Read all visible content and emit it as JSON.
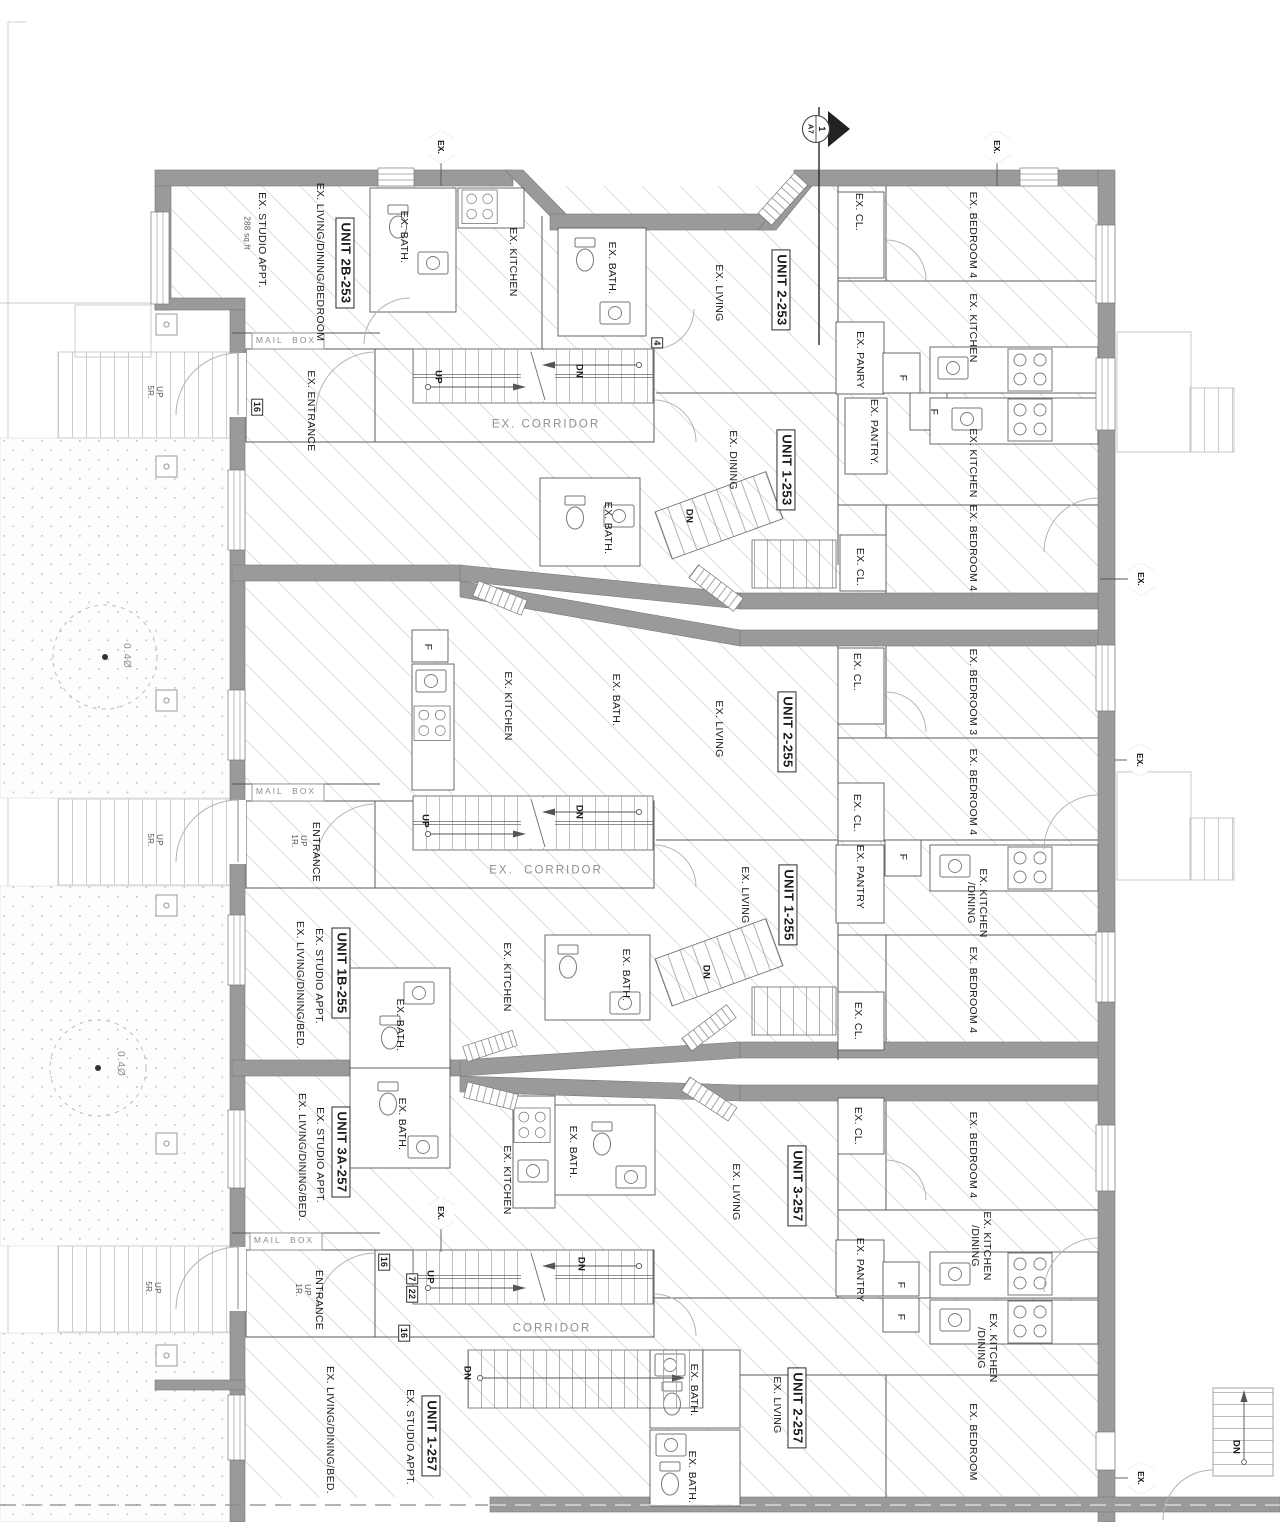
{
  "page": {
    "width": 1280,
    "height": 1522,
    "background": "#ffffff"
  },
  "colors": {
    "wall": "#9a9a9a",
    "wall_stroke": "#787878",
    "partition": "#5a5a5a",
    "hatch": "#dedede",
    "dots": "#c4c4c4",
    "light_outline": "#c8c8c8",
    "text": "#1b1b1b",
    "muted_text": "#8e8e8e"
  },
  "section_marker": {
    "number": "1",
    "sheet": "A7"
  },
  "hexagons": [
    {
      "name": "ex-marker-top-left",
      "text": "EX.",
      "x": 441,
      "y": 147
    },
    {
      "name": "ex-marker-top-right",
      "text": "EX.",
      "x": 997,
      "y": 147
    },
    {
      "name": "ex-marker-right-1",
      "text": "EX.",
      "x": 1141,
      "y": 579
    },
    {
      "name": "ex-marker-right-2",
      "text": "EX.",
      "x": 1140,
      "y": 760
    },
    {
      "name": "ex-marker-mid-bottom",
      "text": "EX.",
      "x": 441,
      "y": 1213
    },
    {
      "name": "ex-marker-bottom-right",
      "text": "EX.",
      "x": 1141,
      "y": 1478
    }
  ],
  "labels": [
    {
      "name": "area-note-unit2b253",
      "text": "288 sq.ft",
      "x": 247,
      "y": 233,
      "rot": 90,
      "style": "small"
    },
    {
      "name": "room-studio-appt-253",
      "text": "EX. STUDIO APPT.",
      "x": 262,
      "y": 240,
      "rot": 90,
      "style": "room"
    },
    {
      "name": "room-living-dining-bedroom-253",
      "text": "EX. LIVING/DINING/BEDROOM",
      "x": 320,
      "y": 262,
      "rot": 90,
      "style": "room"
    },
    {
      "name": "unit-2b-253",
      "text": "UNIT 2B-253",
      "x": 345,
      "y": 263,
      "rot": 90,
      "style": "unit"
    },
    {
      "name": "room-bath-2b253",
      "text": "EX. BATH.",
      "x": 404,
      "y": 237,
      "rot": 90,
      "style": "room"
    },
    {
      "name": "room-kitchen-2b253",
      "text": "EX. KITCHEN",
      "x": 513,
      "y": 262,
      "rot": 90,
      "style": "room"
    },
    {
      "name": "room-bath-2-253",
      "text": "EX. BATH.",
      "x": 612,
      "y": 268,
      "rot": 90,
      "style": "room"
    },
    {
      "name": "room-living-2-253",
      "text": "EX. LIVING",
      "x": 719,
      "y": 293,
      "rot": 90,
      "style": "room"
    },
    {
      "name": "unit-2-253",
      "text": "UNIT 2-253",
      "x": 781,
      "y": 290,
      "rot": 90,
      "style": "unit"
    },
    {
      "name": "room-closet-2-253",
      "text": "EX. CL.",
      "x": 859,
      "y": 212,
      "rot": 90,
      "style": "room"
    },
    {
      "name": "room-bedroom4-2-253",
      "text": "EX. BEDROOM 4",
      "x": 973,
      "y": 235,
      "rot": 90,
      "style": "room"
    },
    {
      "name": "room-pantry-2-253",
      "text": "EX. PANRY",
      "x": 860,
      "y": 360,
      "rot": 90,
      "style": "room"
    },
    {
      "name": "fridge-2-253",
      "text": "F",
      "x": 903,
      "y": 378,
      "rot": 90,
      "style": "room"
    },
    {
      "name": "room-kitchen-2-253",
      "text": "EX. KITCHEN",
      "x": 973,
      "y": 328,
      "rot": 90,
      "style": "room"
    },
    {
      "name": "mailbox-253",
      "text": "MAIL  BOX",
      "x": 286,
      "y": 341,
      "rot": 0,
      "style": "mail"
    },
    {
      "name": "room-entrance-253",
      "text": "EX. ENTRANCE",
      "x": 311,
      "y": 411,
      "rot": 90,
      "style": "room"
    },
    {
      "name": "tag-16-253",
      "text": "16",
      "x": 257,
      "y": 407,
      "rot": 90,
      "style": "tag"
    },
    {
      "name": "stair-up-253",
      "text": "UP",
      "x": 437,
      "y": 377,
      "rot": 90,
      "style": "updn"
    },
    {
      "name": "stair-dn-253",
      "text": "DN",
      "x": 578,
      "y": 371,
      "rot": 90,
      "style": "updn"
    },
    {
      "name": "corridor-253",
      "text": "EX. CORRIDOR",
      "x": 546,
      "y": 425,
      "rot": 0,
      "style": "corr"
    },
    {
      "name": "tag-4-253",
      "text": "4",
      "x": 657,
      "y": 343,
      "rot": 90,
      "style": "tag"
    },
    {
      "name": "room-pantry-1-253",
      "text": "EX. PANTRY.",
      "x": 874,
      "y": 432,
      "rot": 90,
      "style": "room"
    },
    {
      "name": "fridge-1-253",
      "text": "F",
      "x": 934,
      "y": 412,
      "rot": 90,
      "style": "room"
    },
    {
      "name": "room-kitchen-1-253",
      "text": "EX. KITCHEN",
      "x": 973,
      "y": 463,
      "rot": 90,
      "style": "room"
    },
    {
      "name": "room-dining-1-253",
      "text": "EX. DINING",
      "x": 733,
      "y": 460,
      "rot": 90,
      "style": "room"
    },
    {
      "name": "unit-1-253",
      "text": "UNIT 1-253",
      "x": 786,
      "y": 470,
      "rot": 90,
      "style": "unit"
    },
    {
      "name": "room-bath-1-253",
      "text": "EX. BATH.",
      "x": 608,
      "y": 528,
      "rot": 90,
      "style": "room"
    },
    {
      "name": "stair-dn-1-253",
      "text": "DN",
      "x": 688,
      "y": 516,
      "rot": 90,
      "style": "updn"
    },
    {
      "name": "room-closet-1-253",
      "text": "EX. CL.",
      "x": 860,
      "y": 567,
      "rot": 90,
      "style": "room"
    },
    {
      "name": "room-bedroom4-1-253",
      "text": "EX. BEDROOM 4",
      "x": 973,
      "y": 548,
      "rot": 90,
      "style": "room"
    },
    {
      "name": "fridge-2-255",
      "text": "F",
      "x": 428,
      "y": 647,
      "rot": 90,
      "style": "room"
    },
    {
      "name": "room-kitchen-2-255",
      "text": "EX. KITCHEN",
      "x": 508,
      "y": 706,
      "rot": 90,
      "style": "room"
    },
    {
      "name": "room-bath-2-255",
      "text": "EX. BATH.",
      "x": 616,
      "y": 700,
      "rot": 90,
      "style": "room"
    },
    {
      "name": "room-living-2-255",
      "text": "EX. LIVING",
      "x": 719,
      "y": 729,
      "rot": 90,
      "style": "room"
    },
    {
      "name": "unit-2-255",
      "text": "UNIT 2-255",
      "x": 787,
      "y": 732,
      "rot": 90,
      "style": "unit"
    },
    {
      "name": "room-closet-a-2-255",
      "text": "EX. CL.",
      "x": 857,
      "y": 672,
      "rot": 90,
      "style": "room"
    },
    {
      "name": "room-bedroom3-2-255",
      "text": "EX. BEDROOM 3",
      "x": 973,
      "y": 692,
      "rot": 90,
      "style": "room"
    },
    {
      "name": "room-closet-b-2-255",
      "text": "EX. CL.",
      "x": 857,
      "y": 813,
      "rot": 90,
      "style": "room"
    },
    {
      "name": "room-bedroom4-2-255",
      "text": "EX. BEDROOM 4",
      "x": 973,
      "y": 792,
      "rot": 90,
      "style": "room"
    },
    {
      "name": "mailbox-255",
      "text": "MAIL  BOX",
      "x": 286,
      "y": 792,
      "rot": 0,
      "style": "mail"
    },
    {
      "name": "room-entrance-255",
      "text": "ENTRANCE",
      "x": 316,
      "y": 852,
      "rot": 90,
      "style": "room"
    },
    {
      "name": "note-up-1r-255",
      "text": "UP\n1R.",
      "x": 299,
      "y": 841,
      "rot": 90,
      "style": "small"
    },
    {
      "name": "stair-up-255",
      "text": "UP",
      "x": 424,
      "y": 821,
      "rot": 90,
      "style": "updn"
    },
    {
      "name": "stair-dn-255",
      "text": "DN",
      "x": 578,
      "y": 812,
      "rot": 90,
      "style": "updn"
    },
    {
      "name": "corridor-255",
      "text": "EX.  CORRIDOR",
      "x": 546,
      "y": 871,
      "rot": 0,
      "style": "corr"
    },
    {
      "name": "room-pantry-1-255",
      "text": "EX. PANTRY",
      "x": 860,
      "y": 877,
      "rot": 90,
      "style": "room"
    },
    {
      "name": "fridge-1-255",
      "text": "F",
      "x": 903,
      "y": 857,
      "rot": 90,
      "style": "room"
    },
    {
      "name": "room-kitchen-dining-1-255",
      "text": "EX. KITCHEN\n/DINING",
      "x": 977,
      "y": 903,
      "rot": 90,
      "style": "room2"
    },
    {
      "name": "room-living-1-255",
      "text": "EX. LIVING",
      "x": 745,
      "y": 895,
      "rot": 90,
      "style": "room"
    },
    {
      "name": "unit-1-255",
      "text": "UNIT 1-255",
      "x": 788,
      "y": 905,
      "rot": 90,
      "style": "unit"
    },
    {
      "name": "room-bedroom4-1-255",
      "text": "EX. BEDROOM 4",
      "x": 973,
      "y": 990,
      "rot": 90,
      "style": "room"
    },
    {
      "name": "room-closet-1-255",
      "text": "EX. CL.",
      "x": 858,
      "y": 1021,
      "rot": 90,
      "style": "room"
    },
    {
      "name": "stair-dn-1-255",
      "text": "DN",
      "x": 705,
      "y": 972,
      "rot": 90,
      "style": "updn"
    },
    {
      "name": "unit-1b-255",
      "text": "UNIT 1B-255",
      "x": 341,
      "y": 973,
      "rot": 90,
      "style": "unit"
    },
    {
      "name": "room-studio-appt-1b255",
      "text": "EX. STUDIO APPT.",
      "x": 319,
      "y": 976,
      "rot": 90,
      "style": "room"
    },
    {
      "name": "room-living-dining-bed-1b255",
      "text": "EX. LIVING/DINING/BED.",
      "x": 300,
      "y": 985,
      "rot": 90,
      "style": "room"
    },
    {
      "name": "room-bath-a-1b255",
      "text": "EX. BATH.",
      "x": 400,
      "y": 1025,
      "rot": 90,
      "style": "room"
    },
    {
      "name": "room-bath-b-1b255",
      "text": "EX. BATH.",
      "x": 626,
      "y": 975,
      "rot": 90,
      "style": "room"
    },
    {
      "name": "room-kitchen-1b255",
      "text": "EX. KITCHEN",
      "x": 507,
      "y": 977,
      "rot": 90,
      "style": "room"
    },
    {
      "name": "room-bath-a-3a257",
      "text": "EX. BATH.",
      "x": 402,
      "y": 1124,
      "rot": 90,
      "style": "room"
    },
    {
      "name": "room-bath-b-3a257",
      "text": "EX. BATH.",
      "x": 573,
      "y": 1152,
      "rot": 90,
      "style": "room"
    },
    {
      "name": "room-kitchen-3a257",
      "text": "EX. KITCHEN",
      "x": 507,
      "y": 1180,
      "rot": 90,
      "style": "room"
    },
    {
      "name": "unit-3a-257",
      "text": "UNIT 3A-257",
      "x": 341,
      "y": 1152,
      "rot": 90,
      "style": "unit"
    },
    {
      "name": "room-studio-appt-3a257",
      "text": "EX. STUDIO APPT.",
      "x": 320,
      "y": 1155,
      "rot": 90,
      "style": "room"
    },
    {
      "name": "room-living-dining-bed-3a257",
      "text": "EX. LIVING/DINING/BED.",
      "x": 302,
      "y": 1157,
      "rot": 90,
      "style": "room"
    },
    {
      "name": "room-closet-3-257",
      "text": "EX. CL.",
      "x": 858,
      "y": 1126,
      "rot": 90,
      "style": "room"
    },
    {
      "name": "room-bedroom4-3-257",
      "text": "EX. BEDROOM 4",
      "x": 973,
      "y": 1155,
      "rot": 90,
      "style": "room"
    },
    {
      "name": "unit-3-257",
      "text": "UNIT 3-257",
      "x": 797,
      "y": 1186,
      "rot": 90,
      "style": "unit"
    },
    {
      "name": "room-living-3-257",
      "text": "EX. LIVING",
      "x": 736,
      "y": 1192,
      "rot": 90,
      "style": "room"
    },
    {
      "name": "room-kitchen-dining-3-257",
      "text": "EX. KITCHEN\n/DINING",
      "x": 981,
      "y": 1246,
      "rot": 90,
      "style": "room2"
    },
    {
      "name": "room-pantry-3-257",
      "text": "EX. PANTRY",
      "x": 860,
      "y": 1270,
      "rot": 90,
      "style": "room"
    },
    {
      "name": "fridge-3-257",
      "text": "F",
      "x": 901,
      "y": 1285,
      "rot": 90,
      "style": "room"
    },
    {
      "name": "fridge-2-257",
      "text": "F",
      "x": 901,
      "y": 1317,
      "rot": 90,
      "style": "room"
    },
    {
      "name": "room-kitchen-dining-2-257",
      "text": "EX. KITCHEN\n/DINING",
      "x": 987,
      "y": 1348,
      "rot": 90,
      "style": "room2"
    },
    {
      "name": "mailbox-257",
      "text": "MAIL  BOX",
      "x": 284,
      "y": 1241,
      "rot": 0,
      "style": "mail"
    },
    {
      "name": "room-entrance-257",
      "text": "ENTRANCE",
      "x": 319,
      "y": 1300,
      "rot": 90,
      "style": "room"
    },
    {
      "name": "note-up-1r-257",
      "text": "UP\n1R.",
      "x": 303,
      "y": 1290,
      "rot": 90,
      "style": "small"
    },
    {
      "name": "tag-16-257-a",
      "text": "16",
      "x": 384,
      "y": 1262,
      "rot": 90,
      "style": "tag"
    },
    {
      "name": "tag-7-257",
      "text": "7",
      "x": 412,
      "y": 1279,
      "rot": 90,
      "style": "tag"
    },
    {
      "name": "tag-22-257",
      "text": "22",
      "x": 412,
      "y": 1294,
      "rot": 90,
      "style": "tag"
    },
    {
      "name": "stair-up-257",
      "text": "UP",
      "x": 429,
      "y": 1277,
      "rot": 90,
      "style": "updn"
    },
    {
      "name": "stair-dn-257",
      "text": "DN",
      "x": 580,
      "y": 1264,
      "rot": 90,
      "style": "updn"
    },
    {
      "name": "tag-16-257-b",
      "text": "16",
      "x": 404,
      "y": 1333,
      "rot": 90,
      "style": "tag"
    },
    {
      "name": "corridor-257",
      "text": "CORRIDOR",
      "x": 552,
      "y": 1329,
      "rot": 0,
      "style": "corr"
    },
    {
      "name": "stair-dn-lower-257",
      "text": "DN",
      "x": 466,
      "y": 1373,
      "rot": 90,
      "style": "updn"
    },
    {
      "name": "unit-1-257",
      "text": "UNIT 1-257",
      "x": 431,
      "y": 1436,
      "rot": 90,
      "style": "unit"
    },
    {
      "name": "room-studio-appt-1-257",
      "text": "EX. STUDIO APPT.",
      "x": 410,
      "y": 1437,
      "rot": 90,
      "style": "room"
    },
    {
      "name": "room-living-dining-bed-1-257",
      "text": "EX. LIVING/DINING/BED.",
      "x": 330,
      "y": 1430,
      "rot": 90,
      "style": "room"
    },
    {
      "name": "unit-2-257",
      "text": "UNIT 2-257",
      "x": 797,
      "y": 1408,
      "rot": 90,
      "style": "unit"
    },
    {
      "name": "room-living-2-257",
      "text": "EX. LIVING",
      "x": 777,
      "y": 1405,
      "rot": 90,
      "style": "room"
    },
    {
      "name": "room-bedroom-2-257",
      "text": "EX. BEDROOM",
      "x": 973,
      "y": 1442,
      "rot": 90,
      "style": "room"
    },
    {
      "name": "room-bath-a-2-257",
      "text": "EX. BATH.",
      "x": 694,
      "y": 1390,
      "rot": 90,
      "style": "room"
    },
    {
      "name": "room-bath-b-2-257",
      "text": "EX. BATH.",
      "x": 692,
      "y": 1477,
      "rot": 90,
      "style": "room"
    },
    {
      "name": "stair-dn-ext",
      "text": "DN",
      "x": 1235,
      "y": 1447,
      "rot": 90,
      "style": "updn"
    },
    {
      "name": "note-up-5r-1",
      "text": "UP\n5R.",
      "x": 155,
      "y": 392,
      "rot": 90,
      "style": "small"
    },
    {
      "name": "note-up-5r-2",
      "text": "UP\n5R.",
      "x": 155,
      "y": 840,
      "rot": 90,
      "style": "small"
    },
    {
      "name": "note-up-5r-3",
      "text": "UP\n5R.",
      "x": 153,
      "y": 1288,
      "rot": 90,
      "style": "small"
    },
    {
      "name": "tree-size-1",
      "text": "0.4Ø",
      "x": 126,
      "y": 656,
      "rot": 90,
      "style": "small2"
    },
    {
      "name": "tree-size-2",
      "text": "0.4Ø",
      "x": 120,
      "y": 1064,
      "rot": 90,
      "style": "small2"
    }
  ]
}
